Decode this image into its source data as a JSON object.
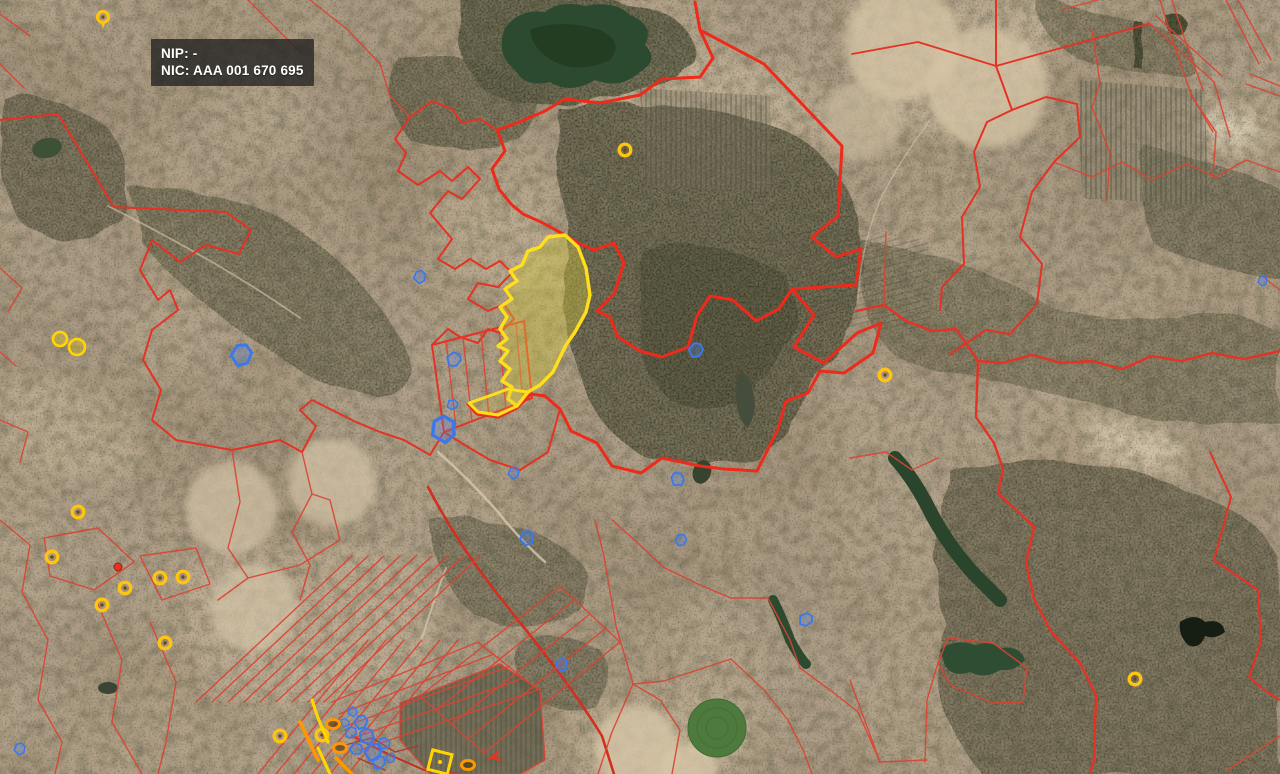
{
  "app": {
    "type": "gis-cadastral-map-viewer"
  },
  "tooltip": {
    "nip": "NIP: -",
    "nic": "NIC: AAA 001 670 695"
  },
  "colors": {
    "parcel_line": "#e8281c",
    "selected_outline": "#ffdf1b",
    "selected_fill": "rgba(214,202,58,0.38)",
    "marker_ring": "#ffc412",
    "marker_ring_center": "#6b4a10",
    "marker_blue": "#3d78e8",
    "marker_blue_fill": "rgba(80,130,230,0.3)",
    "marker_orange": "#ff9800",
    "marker_red": "#e33424",
    "marker_yellow": "#ffd600"
  },
  "markers": {
    "point_rings": [
      [
        625,
        150
      ],
      [
        885,
        375
      ],
      [
        1135,
        679
      ],
      [
        78,
        512
      ],
      [
        52,
        557
      ],
      [
        125,
        588
      ],
      [
        160,
        578
      ],
      [
        183,
        577
      ],
      [
        102,
        605
      ],
      [
        165,
        643
      ],
      [
        280,
        736
      ],
      [
        322,
        735
      ]
    ],
    "pins": [
      [
        103,
        17
      ]
    ],
    "red_dots": [
      [
        118,
        567
      ]
    ],
    "blue_glyphs": [
      [
        240,
        355,
        2.2,
        10
      ],
      [
        442,
        430,
        2.6,
        -15
      ],
      [
        419,
        277,
        1.3,
        0
      ],
      [
        453,
        359,
        1.5,
        30
      ],
      [
        452,
        404,
        1.1,
        60
      ],
      [
        513,
        473,
        1.2,
        0
      ],
      [
        695,
        350,
        1.5,
        20
      ],
      [
        677,
        480,
        1.4,
        -40
      ],
      [
        526,
        538,
        1.5,
        0
      ],
      [
        680,
        540,
        1.2,
        15
      ],
      [
        561,
        665,
        1.3,
        -10
      ],
      [
        805,
        619,
        1.4,
        45
      ],
      [
        1262,
        281,
        1.0,
        0
      ],
      [
        19,
        749,
        1.2,
        0
      ],
      [
        352,
        712,
        1.0,
        -20
      ],
      [
        360,
        722,
        1.4,
        10
      ],
      [
        350,
        732,
        1.2,
        40
      ],
      [
        366,
        737,
        1.6,
        -30
      ],
      [
        356,
        748,
        1.3,
        80
      ],
      [
        372,
        752,
        1.8,
        15
      ],
      [
        384,
        744,
        1.2,
        -60
      ],
      [
        378,
        762,
        1.4,
        30
      ],
      [
        390,
        758,
        1.0,
        0
      ],
      [
        345,
        722,
        0.9,
        120
      ]
    ],
    "yellow_squares": [
      [
        440,
        762,
        14
      ]
    ],
    "orange_ovals": [
      [
        468,
        765
      ],
      [
        333,
        724
      ],
      [
        340,
        748
      ]
    ],
    "red_arrows": [
      [
        487,
        759,
        -15
      ]
    ],
    "yellow_blobs": [
      [
        60,
        339,
        7
      ],
      [
        77,
        347,
        8
      ]
    ],
    "yellow_lines": [
      "M312,700 l6,18 l10,24",
      "M318,748 L330,774"
    ],
    "orange_lines": [
      "M300,722 L318,760",
      "M336,758 L352,774"
    ]
  }
}
